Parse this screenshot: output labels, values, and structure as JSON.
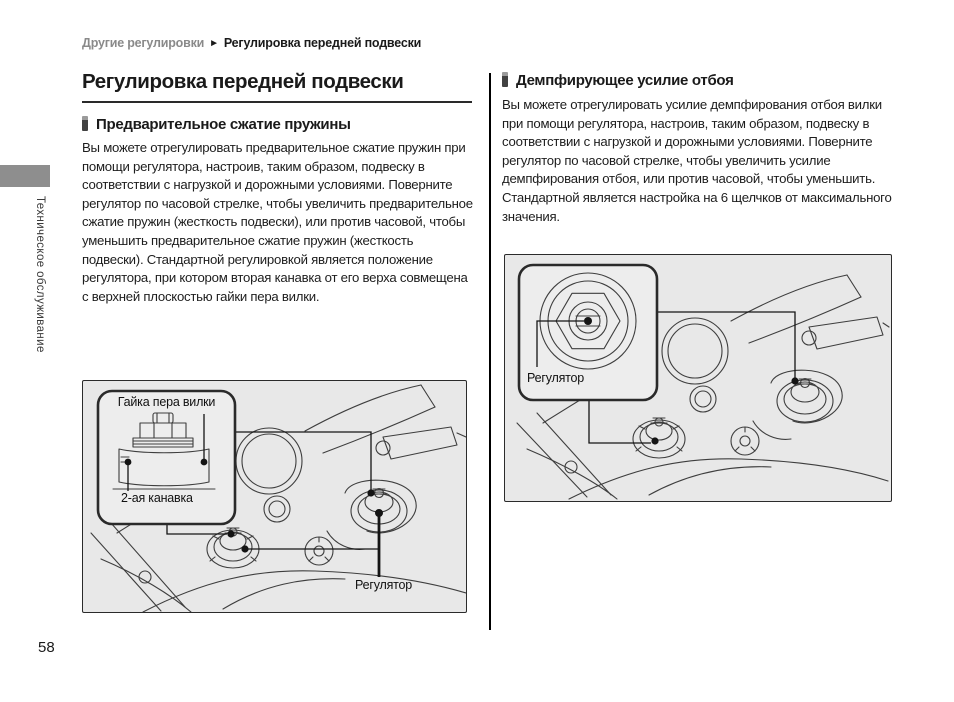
{
  "breadcrumb": {
    "parent": "Другие регулировки",
    "separator": "►",
    "current": "Регулировка передней подвески"
  },
  "sidebar": {
    "chapter": "Техническое обслуживание"
  },
  "left_column": {
    "title": "Регулировка передней подвески",
    "section_heading": "Предварительное сжатие пружины",
    "body": "Вы можете отрегулировать предварительное сжатие пружин при помощи регулятора, настроив, таким образом, подвеску в соответствии с нагрузкой и дорожными условиями. Поверните регулятор по часовой стрелке, чтобы увеличить предварительное сжатие пружин (жесткость подвески), или против часовой, чтобы уменьшить предварительное сжатие пружин (жесткость подвески). Стандартной регулировкой является положение регулятора, при котором вторая канавка от его верха совмещена с верхней плоскостью гайки пера вилки.",
    "figure": {
      "label_fork_cap_nut": "Гайка пера вилки",
      "label_second_groove": "2-ая канавка",
      "label_adjuster": "Регулятор"
    }
  },
  "right_column": {
    "section_heading": "Демпфирующее усилие отбоя",
    "body": "Вы можете отрегулировать усилие демпфирования отбоя вилки при помощи регулятора, настроив, таким образом, подвеску в соответствии с нагрузкой и дорожными условиями. Поверните регулятор по часовой стрелке, чтобы увеличить усилие демпфирования отбоя, или против часовой, чтобы уменьшить. Стандартной является настройка на 6 щелчков от максимального значения.",
    "figure": {
      "label_adjuster": "Регулятор"
    }
  },
  "page": {
    "number": "58"
  },
  "colors": {
    "breadcrumb_parent": "#8a8a8a",
    "sidebar_tab": "#8e8e8e",
    "figure_background": "#e8e8e8",
    "text": "#1a1a1a"
  }
}
